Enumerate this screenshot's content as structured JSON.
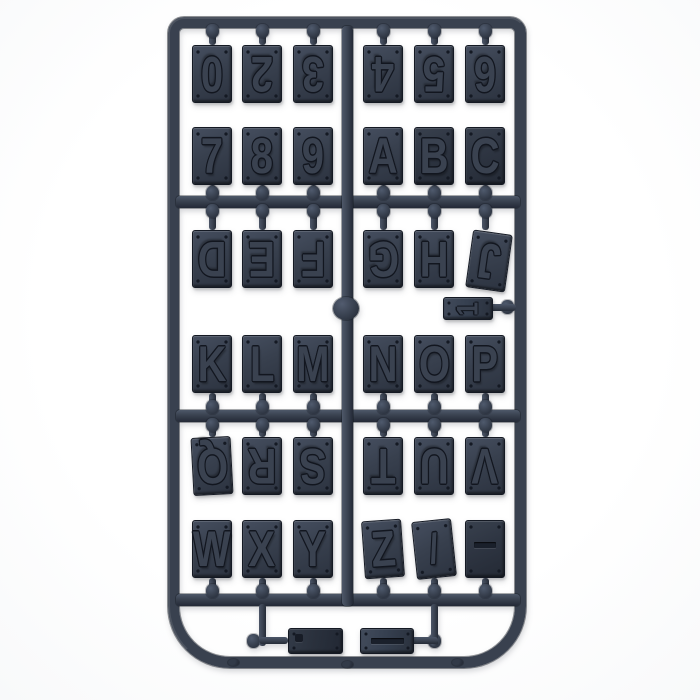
{
  "scene": {
    "type": "product-photo",
    "subject": "Injection-moulded plastic sprue holding letter, number and symbol tiles",
    "background_color": "#ffffff",
    "plastic_color": "#39414f",
    "plastic_dark_color": "#1a1f29",
    "plastic_light_color": "#515b6e",
    "glyph_outline_color": "#12161f"
  },
  "sprue": {
    "rows": [
      {
        "position": "row-1",
        "attach": "above",
        "inverted": true,
        "left": [
          {
            "glyph": "0"
          },
          {
            "glyph": "2"
          },
          {
            "glyph": "3"
          }
        ],
        "right": [
          {
            "glyph": "4"
          },
          {
            "glyph": "5"
          },
          {
            "glyph": "6"
          }
        ]
      },
      {
        "position": "row-2",
        "attach": "below",
        "inverted": false,
        "left": [
          {
            "glyph": "7"
          },
          {
            "glyph": "8"
          },
          {
            "glyph": "9"
          }
        ],
        "right": [
          {
            "glyph": "A"
          },
          {
            "glyph": "B",
            "dark": true
          },
          {
            "glyph": "C",
            "dark": true
          }
        ]
      },
      {
        "position": "row-3",
        "attach": "above",
        "inverted": true,
        "left": [
          {
            "glyph": "D"
          },
          {
            "glyph": "E"
          },
          {
            "glyph": "F"
          }
        ],
        "right": [
          {
            "glyph": "G"
          },
          {
            "glyph": "H"
          },
          {
            "glyph": "J",
            "tilt": 8,
            "dx": 4,
            "dy": 2
          }
        ]
      },
      {
        "position": "row-4",
        "attach": "below",
        "inverted": false,
        "left": [
          {
            "glyph": "K"
          },
          {
            "glyph": "L"
          },
          {
            "glyph": "M"
          }
        ],
        "right": [
          {
            "glyph": "N"
          },
          {
            "glyph": "O"
          },
          {
            "glyph": "P"
          }
        ]
      },
      {
        "position": "row-5",
        "attach": "above",
        "inverted": true,
        "left": [
          {
            "glyph": "Q",
            "tilt": -3
          },
          {
            "glyph": "R"
          },
          {
            "glyph": "S"
          }
        ],
        "right": [
          {
            "glyph": "T"
          },
          {
            "glyph": "U"
          },
          {
            "glyph": "V"
          }
        ]
      },
      {
        "position": "row-6",
        "attach": "below",
        "inverted": false,
        "left": [
          {
            "glyph": "W"
          },
          {
            "glyph": "X"
          },
          {
            "glyph": "Y"
          }
        ],
        "right": [
          {
            "glyph": "Z",
            "tilt": -4
          },
          {
            "glyph": "/",
            "tilt": -6
          },
          {
            "glyph": "-",
            "dark": true,
            "bar": true
          }
        ]
      }
    ],
    "small_parts": [
      {
        "glyph": "1",
        "type": "one",
        "location": "middle-right"
      },
      {
        "glyph": ".",
        "type": "dot",
        "location": "bottom-left",
        "dark": true
      },
      {
        "glyph": "I",
        "type": "bar",
        "location": "bottom-right"
      }
    ]
  }
}
